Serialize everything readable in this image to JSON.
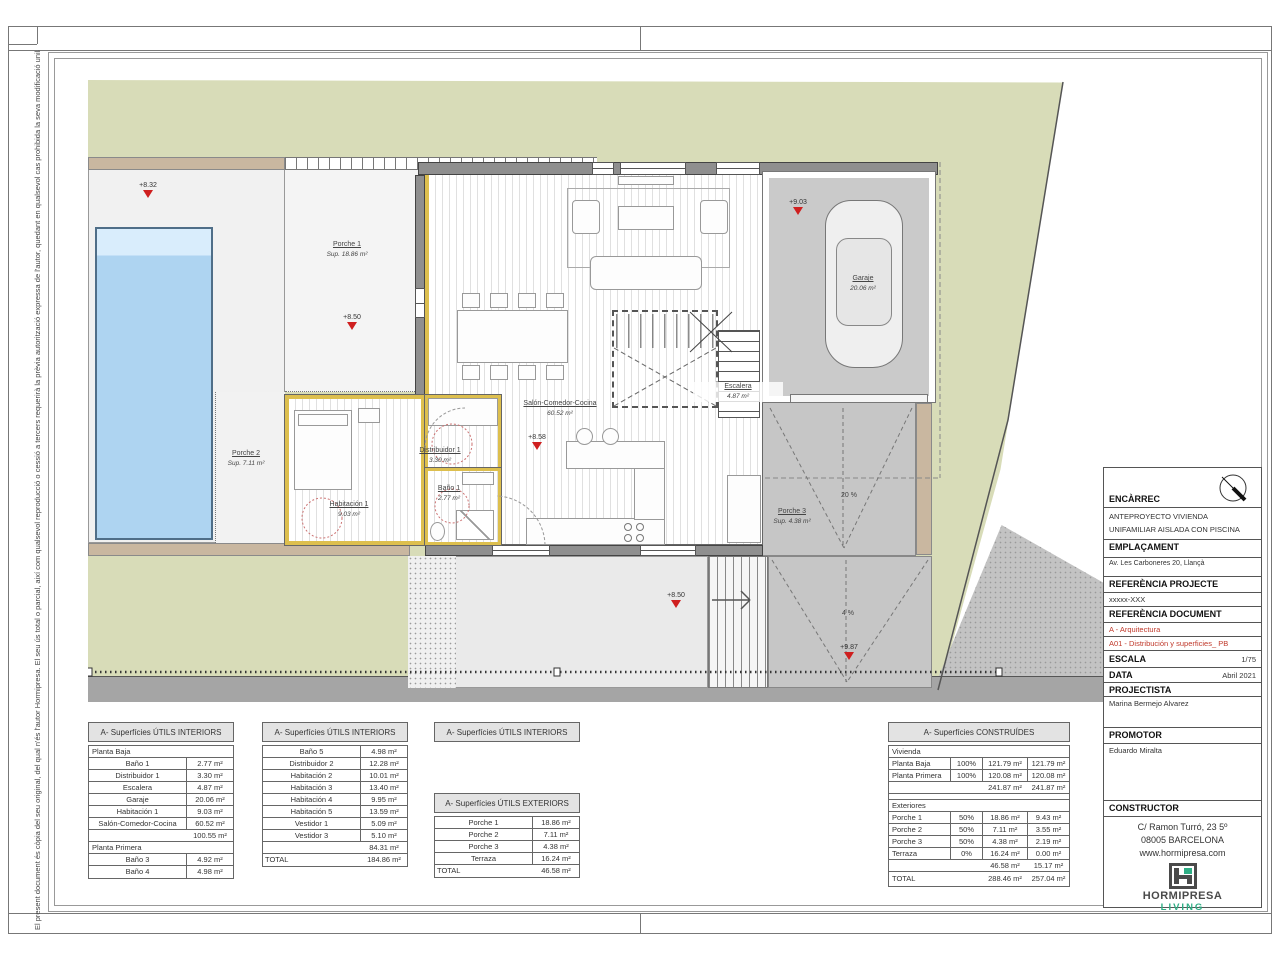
{
  "disclaimer": "El present document és còpia del seu original, del qual n'és l'autor Hormipresa.  El seu ús total o parcial, així com qualsevol reproducció o cessió a tercers requerirà la prèvia autorització expressa de l'autor, quedant en qualsevol cas prohibida la seva modificació unilateral.",
  "plan": {
    "rooms": {
      "porche1": {
        "name": "Porche 1",
        "area": "Sup. 18.86 m²"
      },
      "porche2": {
        "name": "Porche 2",
        "area": "Sup. 7.11 m²"
      },
      "habitacion1": {
        "name": "Habitación 1",
        "area": "9.03 m²"
      },
      "distribuidor1": {
        "name": "Distribuidor 1",
        "area": "3.30 m²"
      },
      "bano1": {
        "name": "Baño 1",
        "area": "2.77 m²"
      },
      "salon": {
        "name": "Salón-Comedor-Cocina",
        "area": "60.52 m²"
      },
      "escalera": {
        "name": "Escalera",
        "area": "4.87 m²"
      },
      "garaje": {
        "name": "Garaje",
        "area": "20.06 m²"
      },
      "porche3": {
        "name": "Porche 3",
        "area": "Sup. 4.38 m²"
      }
    },
    "markers": {
      "m832": "+8.32",
      "m850a": "+8.50",
      "m903": "+9.03",
      "m858": "+8.58",
      "m850b": "+8.50",
      "m987": "+9.87"
    },
    "slopes": {
      "upper": "20 %",
      "lower": "4 %"
    }
  },
  "title_block": {
    "encarrec_label": "ENCÀRREC",
    "encarrec_line1": "ANTEPROYECTO VIVIENDA",
    "encarrec_line2": "UNIFAMILIAR AISLADA CON PISCINA",
    "emplacament_label": "EMPLAÇAMENT",
    "emplacament_value": "Av. Les Carboneres 20, Llançà",
    "ref_projecte_label": "REFERÈNCIA PROJECTE",
    "ref_projecte_value": "xxxxx-XXX",
    "ref_document_label": "REFERÈNCIA DOCUMENT",
    "ref_document_line1": "A - Arquitectura",
    "ref_document_line2": "A01 - Distribución y superficies_ PB",
    "escala_label": "ESCALA",
    "escala_value": "1/75",
    "data_label": "DATA",
    "data_value": "Abril 2021",
    "projectista_label": "PROJECTISTA",
    "projectista_value": "Marina Bermejo Alvarez",
    "promotor_label": "PROMOTOR",
    "promotor_value": "Eduardo Miralta",
    "constructor_label": "CONSTRUCTOR",
    "constructor_addr1": "C/ Ramon Turró, 23 5º",
    "constructor_addr2": "08005 BARCELONA",
    "constructor_web": "www.hormipresa.com",
    "brand_name": "HORMIPRESA",
    "brand_sub": "LIVING",
    "brand_green": "#2fae85",
    "accent_red": "#c0392b"
  },
  "tables": {
    "int1": {
      "title": "A- Superfícies ÚTILS INTERIORS",
      "span1": "Planta Baja",
      "r": [
        [
          "Baño 1",
          "2.77 m²"
        ],
        [
          "Distribuidor 1",
          "3.30 m²"
        ],
        [
          "Escalera",
          "4.87 m²"
        ],
        [
          "Garaje",
          "20.06 m²"
        ],
        [
          "Habitación 1",
          "9.03 m²"
        ],
        [
          "Salón-Comedor-Cocina",
          "60.52 m²"
        ]
      ],
      "sub": "100.55 m²",
      "span2": "Planta Primera",
      "r2": [
        [
          "Baño 3",
          "4.92 m²"
        ],
        [
          "Baño 4",
          "4.98 m²"
        ]
      ]
    },
    "int2": {
      "title": "A- Superfícies ÚTILS INTERIORS",
      "r": [
        [
          "Baño 5",
          "4.98 m²"
        ],
        [
          "Distribuidor 2",
          "12.28 m²"
        ],
        [
          "Habitación 2",
          "10.01 m²"
        ],
        [
          "Habitación 3",
          "13.40 m²"
        ],
        [
          "Habitación 4",
          "9.95 m²"
        ],
        [
          "Habitación 5",
          "13.59 m²"
        ],
        [
          "Vestidor 1",
          "5.09 m²"
        ],
        [
          "Vestidor 3",
          "5.10 m²"
        ]
      ],
      "sub": "84.31 m²",
      "total_label": "TOTAL",
      "total": "184.86 m²"
    },
    "int3_title": "A- Superfícies ÚTILS INTERIORS",
    "ext": {
      "title": "A- Superfícies ÚTILS EXTERIORS",
      "r": [
        [
          "Porche 1",
          "18.86 m²"
        ],
        [
          "Porche 2",
          "7.11 m²"
        ],
        [
          "Porche 3",
          "4.38 m²"
        ],
        [
          "Terraza",
          "16.24 m²"
        ]
      ],
      "total_label": "TOTAL",
      "total": "46.58 m²"
    },
    "con": {
      "title": "A- Superfícies CONSTRUÍDES",
      "span1": "Vivienda",
      "r": [
        [
          "Planta Baja",
          "100%",
          "121.79 m²",
          "121.79 m²"
        ],
        [
          "Planta Primera",
          "100%",
          "120.08 m²",
          "120.08 m²"
        ]
      ],
      "sub": [
        "241.87 m²",
        "241.87 m²"
      ],
      "span2": "Exteriores",
      "r2": [
        [
          "Porche 1",
          "50%",
          "18.86 m²",
          "9.43 m²"
        ],
        [
          "Porche 2",
          "50%",
          "7.11 m²",
          "3.55 m²"
        ],
        [
          "Porche 3",
          "50%",
          "4.38 m²",
          "2.19 m²"
        ],
        [
          "Terraza",
          "0%",
          "16.24 m²",
          "0.00 m²"
        ]
      ],
      "sub2": [
        "46.58 m²",
        "15.17 m²"
      ],
      "total_label": "TOTAL",
      "total": [
        "288.46 m²",
        "257.04 m²"
      ]
    }
  }
}
